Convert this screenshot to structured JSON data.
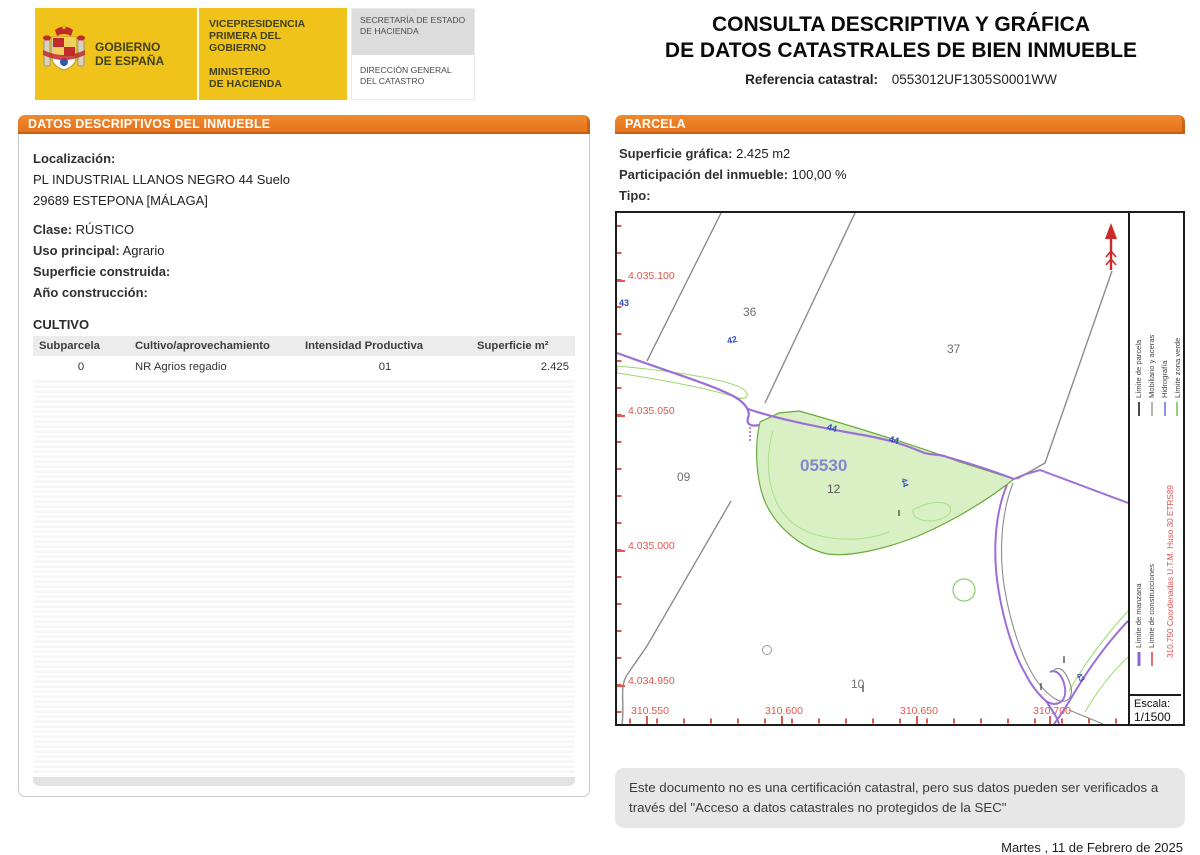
{
  "masthead": {
    "gov_line1": "GOBIERNO",
    "gov_line2": "DE ESPAÑA",
    "vice_line1": "VICEPRESIDENCIA",
    "vice_line2": "PRIMERA DEL GOBIERNO",
    "min_line1": "MINISTERIO",
    "min_line2": "DE HACIENDA",
    "sec_line1": "SECRETARÍA DE ESTADO",
    "sec_line2": "DE HACIENDA",
    "dir_line1": "DIRECCIÓN GENERAL",
    "dir_line2": "DEL CATASTRO",
    "title_line1": "CONSULTA DESCRIPTIVA Y GRÁFICA",
    "title_line2": "DE DATOS CATASTRALES DE BIEN INMUEBLE",
    "ref_label": "Referencia catastral:",
    "ref_value": "0553012UF1305S0001WW"
  },
  "left_panel": {
    "header": "DATOS DESCRIPTIVOS DEL INMUEBLE",
    "localizacion_label": "Localización:",
    "localizacion_line1": "PL INDUSTRIAL LLANOS NEGRO 44 Suelo",
    "localizacion_line2": "29689 ESTEPONA [MÁLAGA]",
    "clase_label": "Clase:",
    "clase_value": "RÚSTICO",
    "uso_label": "Uso principal:",
    "uso_value": "Agrario",
    "superficie_label": "Superficie construida:",
    "superficie_value": "",
    "ano_label": "Año construcción:",
    "ano_value": "",
    "cultivo_title": "CULTIVO",
    "cultivo_table": {
      "headers": [
        "Subparcela",
        "Cultivo/aprovechamiento",
        "Intensidad Productiva",
        "Superficie m²"
      ],
      "rows": [
        [
          "0",
          "NR Agrios regadio",
          "01",
          "2.425"
        ]
      ]
    }
  },
  "right_panel": {
    "header": "PARCELA",
    "superficie_label": "Superficie gráfica:",
    "superficie_value": "2.425 m2",
    "participacion_label": "Participación del inmueble:",
    "participacion_value": "100,00 %",
    "tipo_label": "Tipo:",
    "tipo_value": ""
  },
  "map": {
    "parcel_ref": "05530",
    "numbers": {
      "p36": "36",
      "p37": "37",
      "p09": "09",
      "p12": "12",
      "p10": "10"
    },
    "road_labels": {
      "l43": "43",
      "l42": "42",
      "l44a": "44",
      "l44b": "44",
      "l44c": "44",
      "l43b": "43"
    },
    "y_labels": [
      "4.035.100",
      "4.035.050",
      "4.035.000",
      "4.034.950"
    ],
    "x_labels": [
      "310.550",
      "310.600",
      "310.650",
      "310.700"
    ],
    "legend": {
      "manzana": {
        "label": "Límite de manzana",
        "color": "#8a64d8"
      },
      "parcela": {
        "label": "Límite de parcela",
        "color": "#4a4a4a"
      },
      "construcciones": {
        "label": "Límite de construcciones",
        "color": "#e07070"
      },
      "mobiliario": {
        "label": "Mobiliario y aceras",
        "color": "#b4b4b4"
      },
      "hidrografia": {
        "label": "Hidrografía",
        "color": "#9090e8"
      },
      "zona_verde": {
        "label": "Límite zona verde",
        "color": "#8fd078"
      }
    },
    "coords_note": "310.750 Coordenadas U.T.M. Huso 30 ETRS89",
    "escala_label": "Escala:",
    "escala_value": "1/1500",
    "colors": {
      "parcel_fill": "#d9f0c5",
      "parcel_stroke": "#6aaa3a",
      "road_purple": "#9b6fd6",
      "boundary_gray": "#8c8c8c",
      "axis_red": "#e2574c",
      "label_blue": "#2f4bc0",
      "ref_text": "#8585cc",
      "north_red": "#cc2a2a"
    }
  },
  "footer": {
    "disclaimer_line1": "Este documento no es una certificación catastral, pero sus datos pueden ser verificados a",
    "disclaimer_line2": "través del \"Acceso a datos catastrales no protegidos de la SEC\"",
    "date": "Martes , 11 de Febrero de 2025"
  }
}
